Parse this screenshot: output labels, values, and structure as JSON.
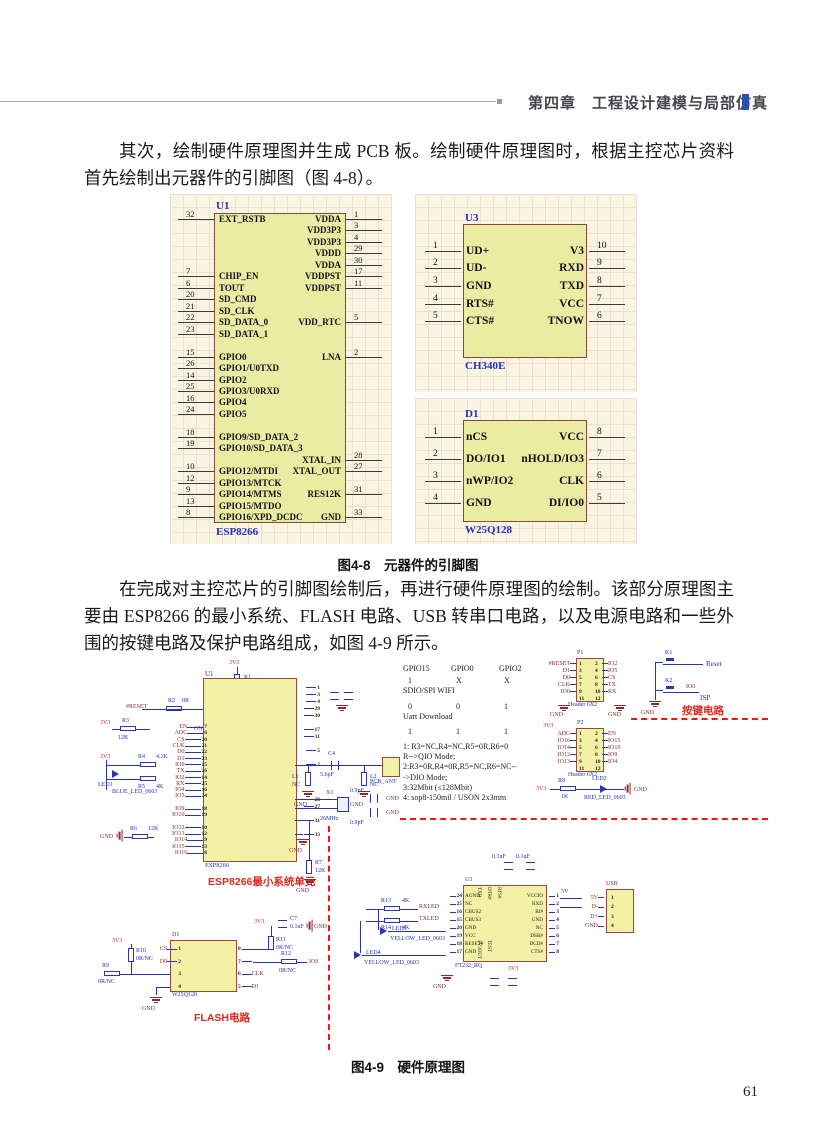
{
  "header": {
    "chapter": "第四章",
    "title": "工程设计建模与局部仿真"
  },
  "page_number": "61",
  "para1": "其次，绘制硬件原理图并生成 PCB 板。绘制硬件原理图时，根据主控芯片资料首先绘制出元器件的引脚图（图 4-8）。",
  "para2": "在完成对主控芯片的引脚图绘制后，再进行硬件原理图的绘制。该部分原理图主要由 ESP8266 的最小系统、FLASH 电路、USB 转串口电路，以及电源电路和一些外围的按键电路及保护电路组成，如图 4-9 所示。",
  "fig48": {
    "caption": "图4-8　元器件的引脚图",
    "u1": {
      "designator": "U1",
      "name": "ESP8266",
      "rows": [
        {
          "ln": "32",
          "ll": "EXT_RSTB",
          "rn": "1",
          "rl": "VDDA"
        },
        {
          "ln": "",
          "ll": "",
          "rn": "3",
          "rl": "VDD3P3"
        },
        {
          "ln": "",
          "ll": "",
          "rn": "4",
          "rl": "VDD3P3"
        },
        {
          "ln": "",
          "ll": "",
          "rn": "29",
          "rl": "VDDD"
        },
        {
          "ln": "",
          "ll": "",
          "rn": "30",
          "rl": "VDDA"
        },
        {
          "ln": "7",
          "ll": "CHIP_EN",
          "rn": "17",
          "rl": "VDDPST"
        },
        {
          "ln": "6",
          "ll": "TOUT",
          "rn": "11",
          "rl": "VDDPST"
        },
        {
          "ln": "20",
          "ll": "SD_CMD",
          "rn": "",
          "rl": ""
        },
        {
          "ln": "21",
          "ll": "SD_CLK",
          "rn": "",
          "rl": ""
        },
        {
          "ln": "22",
          "ll": "SD_DATA_0",
          "rn": "5",
          "rl": "VDD_RTC"
        },
        {
          "ln": "23",
          "ll": "SD_DATA_1",
          "rn": "",
          "rl": ""
        },
        {
          "ln": "",
          "ll": "",
          "rn": "",
          "rl": ""
        },
        {
          "ln": "15",
          "ll": "GPIO0",
          "rn": "2",
          "rl": "LNA"
        },
        {
          "ln": "26",
          "ll": "GPIO1/U0TXD",
          "rn": "",
          "rl": ""
        },
        {
          "ln": "14",
          "ll": "GPIO2",
          "rn": "",
          "rl": ""
        },
        {
          "ln": "25",
          "ll": "GPIO3/U0RXD",
          "rn": "",
          "rl": ""
        },
        {
          "ln": "16",
          "ll": "GPIO4",
          "rn": "",
          "rl": ""
        },
        {
          "ln": "24",
          "ll": "GPIO5",
          "rn": "",
          "rl": ""
        },
        {
          "ln": "",
          "ll": "",
          "rn": "",
          "rl": ""
        },
        {
          "ln": "18",
          "ll": "GPIO9/SD_DATA_2",
          "rn": "",
          "rl": ""
        },
        {
          "ln": "19",
          "ll": "GPIO10/SD_DATA_3",
          "rn": "",
          "rl": ""
        },
        {
          "ln": "",
          "ll": "",
          "rn": "28",
          "rl": "XTAL_IN"
        },
        {
          "ln": "10",
          "ll": "GPIO12/MTDI",
          "rn": "27",
          "rl": "XTAL_OUT"
        },
        {
          "ln": "12",
          "ll": "GPIO13/MTCK",
          "rn": "",
          "rl": ""
        },
        {
          "ln": "9",
          "ll": "GPIO14/MTMS",
          "rn": "31",
          "rl": "RES12K"
        },
        {
          "ln": "13",
          "ll": "GPIO15/MTDO",
          "rn": "",
          "rl": ""
        },
        {
          "ln": "8",
          "ll": "GPIO16/XPD_DCDC",
          "rn": "33",
          "rl": "GND"
        }
      ]
    },
    "u3": {
      "designator": "U3",
      "name": "CH340E",
      "rows": [
        {
          "ln": "1",
          "ll": "UD+",
          "rn": "10",
          "rl": "V3"
        },
        {
          "ln": "2",
          "ll": "UD-",
          "rn": "9",
          "rl": "RXD"
        },
        {
          "ln": "3",
          "ll": "GND",
          "rn": "8",
          "rl": "TXD"
        },
        {
          "ln": "4",
          "ll": "RTS#",
          "rn": "7",
          "rl": "VCC"
        },
        {
          "ln": "5",
          "ll": "CTS#",
          "rn": "6",
          "rl": "TNOW"
        }
      ]
    },
    "d1": {
      "designator": "D1",
      "name": "W25Q128",
      "rows": [
        {
          "ln": "1",
          "ll": "nCS",
          "rn": "8",
          "rl": "VCC"
        },
        {
          "ln": "2",
          "ll": "DO/IO1",
          "rn": "7",
          "rl": "nHOLD/IO3"
        },
        {
          "ln": "3",
          "ll": "nWP/IO2",
          "rn": "6",
          "rl": "CLK"
        },
        {
          "ln": "4",
          "ll": "GND",
          "rn": "5",
          "rl": "DI/IO0"
        }
      ]
    }
  },
  "fig49": {
    "caption": "图4-9　硬件原理图",
    "esp": {
      "designator": "U1",
      "name": "ESP8266",
      "region": "ESP8266最小系统单元",
      "v1": "3V3",
      "r1": "R1",
      "r1v": "2K",
      "reset": "#RESET",
      "r2": "R2",
      "r2v": "0R",
      "c1": "C1",
      "c1v": "1uF",
      "gnd1": "GND",
      "v2": "3V3",
      "r3": "R3",
      "r3v": "12K",
      "v3": "3V3",
      "led1": "LED1",
      "led1n": "BLUE_LED_0603",
      "r4": "R4",
      "r4v": "4.2K",
      "r5": "R5",
      "r5v": "4K",
      "gnd2": "GND",
      "r6": "R6",
      "r6v": "12K",
      "gnd3": "GND",
      "r7": "R7",
      "r7v": "12K",
      "gnd4": "GND",
      "pins": [
        {
          "s": "EN",
          "n": "7"
        },
        {
          "s": "ADC",
          "n": "6"
        },
        {
          "s": "CS",
          "n": "20"
        },
        {
          "s": "CLK",
          "n": "21"
        },
        {
          "s": "D0",
          "n": "22"
        },
        {
          "s": "D1",
          "n": "23"
        },
        {
          "s": "IO0",
          "n": "15"
        },
        {
          "s": "TX",
          "n": "26"
        },
        {
          "s": "IO2",
          "n": "14"
        },
        {
          "s": "RX",
          "n": "25"
        },
        {
          "s": "IO4",
          "n": "16"
        },
        {
          "s": "IO5",
          "n": "24"
        },
        {
          "s": "",
          "n": ""
        },
        {
          "s": "IO9",
          "n": "18"
        },
        {
          "s": "IO10",
          "n": "19"
        },
        {
          "s": "",
          "n": ""
        },
        {
          "s": "IO12",
          "n": "10"
        },
        {
          "s": "IO13",
          "n": "12"
        },
        {
          "s": "IO14",
          "n": "9"
        },
        {
          "s": "IO15",
          "n": "13"
        },
        {
          "s": "IO16",
          "n": "8"
        }
      ],
      "rpins": [
        "1",
        "3",
        "4",
        "29",
        "30",
        "",
        "17",
        "11",
        "",
        "5",
        "",
        "2",
        "",
        "",
        "",
        "",
        "28",
        "27",
        "",
        "31",
        "",
        "33"
      ]
    },
    "ant": {
      "c4": "C4",
      "c4v": "5.6pF",
      "l1": "L1",
      "l1v": "NC",
      "l2": "L2",
      "l2v": "NC",
      "name": "PCB_ANT",
      "gnd1": "GND",
      "gnd2": "GND"
    },
    "xtal": {
      "name": "X1",
      "value": "26MHz",
      "c5v": "0.9pF",
      "c6v": "0.9pF",
      "gnd1": "GND",
      "gnd2": "GND"
    },
    "boot": {
      "cols": [
        "GPIO15",
        "GPIO0",
        "GPIO2"
      ],
      "r1": [
        "1",
        "X",
        "X"
      ],
      "l1": "SDIO/SPI WIFI",
      "r2": [
        "0",
        "0",
        "1"
      ],
      "l2": "Uart Download",
      "r3": [
        "1",
        "1",
        "1"
      ],
      "notes": [
        "1: R3=NC,R4=NC,R5=0R,R6=0",
        "R-->QIO Mode;",
        "2:R3=0R,R4=0R,R5=NC,R6=NC--",
        "->DIO Mode;",
        "3:32Mbit (≤128Mbit)",
        "4: sop8-150mil / USON 2x3mm"
      ]
    },
    "p1": {
      "designator": "P1",
      "name": "Header 6X2",
      "lnums": [
        "1",
        "3",
        "5",
        "7",
        "9",
        "11"
      ],
      "rnums": [
        "2",
        "4",
        "6",
        "8",
        "10",
        "12"
      ],
      "lsigs": [
        "#RESET",
        "D1",
        "D0",
        "CLK",
        "IO0",
        ""
      ],
      "rsigs": [
        "IO2",
        "IO5",
        "CS",
        "TX",
        "RX",
        ""
      ],
      "gndl": "GND",
      "gndr": "GND"
    },
    "p2": {
      "designator": "P2",
      "name": "Header 6X2",
      "pwr": "3V3",
      "lnums": [
        "1",
        "3",
        "5",
        "7",
        "9",
        "11"
      ],
      "rnums": [
        "2",
        "4",
        "6",
        "8",
        "10",
        "12"
      ],
      "lsigs": [
        "ADC",
        "IO16",
        "IO14",
        "IO12",
        "IO13",
        ""
      ],
      "rsigs": [
        "EN",
        "IO15",
        "IO10",
        "IO9",
        "IO4",
        ""
      ]
    },
    "led2": {
      "pwr": "3V3",
      "r8": "R8",
      "r8v": "1K",
      "led": "LED2",
      "name": "RED_LED_0603",
      "gnd": "GND"
    },
    "keys": {
      "k1": "K1",
      "k2": "K2",
      "reset": "Reset",
      "isp": "ISP",
      "io0": "IO0",
      "gnd": "GND",
      "region": "按键电路"
    },
    "flash": {
      "designator": "D1",
      "name": "W25Q128",
      "region": "FLASH电路",
      "pwr1": "3V3",
      "r10": "R10",
      "r10v": "0R/NC",
      "r9": "R9",
      "r9v": "0R/NC",
      "gnd1": "GND",
      "lpins": [
        {
          "s": "CS",
          "n": "1"
        },
        {
          "s": "D0",
          "n": "2"
        },
        {
          "s": "",
          "n": "3"
        },
        {
          "s": "",
          "n": "4"
        }
      ],
      "rpins": [
        {
          "n": "8",
          "s": ""
        },
        {
          "n": "7",
          "s": ""
        },
        {
          "n": "6",
          "s": "CLK"
        },
        {
          "n": "5",
          "s": "D1"
        }
      ],
      "pwr2": "3V3",
      "c7": "C7",
      "c7v": "0.1uF",
      "r11": "R11",
      "r11v": "0R/NC",
      "gnd2": "GND",
      "r12": "R12",
      "r12v": "0R/NC",
      "io0": "IO0"
    },
    "ft": {
      "designator": "U3",
      "name": "FT232_RQ",
      "lnums": [
        "24",
        "25",
        "16",
        "15",
        "20",
        "19",
        "18",
        "17"
      ],
      "lsigs": [
        "AGND",
        "NC",
        "CBUS2",
        "CBUS3",
        "GND",
        "VCC",
        "RESET#",
        "GND"
      ],
      "rsigs": [
        "VCCIO",
        "RXD",
        "RI#",
        "GND",
        "NC",
        "DSR#",
        "DCD#",
        "CTS#"
      ],
      "rnums": [
        "1",
        "2",
        "3",
        "4",
        "5",
        "6",
        "7",
        "8"
      ],
      "tsigs": [
        "TXD",
        "DTR#",
        "RTS#"
      ],
      "bsigs": [
        "3V3OUT",
        "TEST"
      ],
      "c1v": "0.1uF",
      "c2v": "0.1uF",
      "pwr": "3V3",
      "v5": "5V",
      "gnd": "GND"
    },
    "usb": {
      "title": "USB",
      "nums": [
        "1",
        "2",
        "3",
        "4"
      ],
      "sigs": [
        "5V",
        "D-",
        "D+",
        "GND"
      ]
    },
    "led34": {
      "r13": "R13",
      "r13v": "4K",
      "r14": "R14",
      "r14v": "4K",
      "rx": "RXLED",
      "tx": "TXLED",
      "led3": "LED3",
      "led3n": "YELLOW_LED_0603",
      "led4": "LED4",
      "led4n": "YELLOW_LED_0603"
    }
  }
}
